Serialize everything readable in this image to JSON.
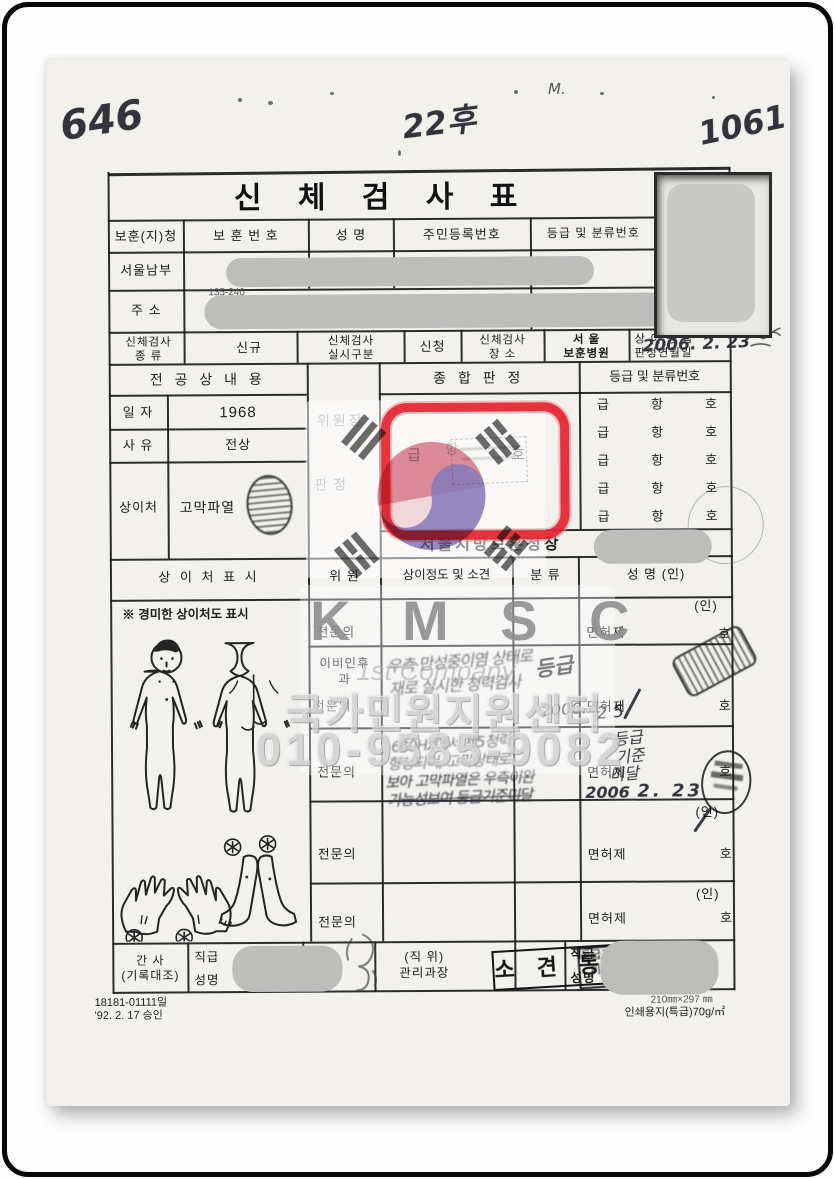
{
  "scan_margin_notes": {
    "left": "646",
    "center": "22후",
    "right": "1061",
    "speck": "M."
  },
  "form": {
    "title": "신  체  검  사  표",
    "header": {
      "office_col": "보훈(지)청",
      "vet_no_col": "보 훈 번 호",
      "name_col": "성    명",
      "resident_no_col": "주민등록번호",
      "grade_col": "등급 및 분류번호",
      "office_value": "서울남부"
    },
    "address": {
      "label": "주   소",
      "zip": "135-240"
    },
    "exam_row": {
      "kind_l1": "신체검사",
      "kind_l2": "종    류",
      "kind_value": "신규",
      "method_l1": "신체검사",
      "method_l2": "실시구분",
      "method_value": "신청",
      "place_l1": "신체검사",
      "place_l2": "장      소",
      "place_v1": "서    울",
      "place_v2": "보훈병원",
      "date_l1": "상 이 등 급",
      "date_l2": "판정연월일",
      "date_value": "2006. 2. 23"
    },
    "merit": {
      "header": "전  공  상  내  용",
      "date_label": "일  자",
      "date_value": "1968",
      "cause_label": "사  유",
      "cause_value": "전상",
      "wound_label": "상이처",
      "wound_value": "고막파열"
    },
    "judgement": {
      "chairman": "위원장",
      "decision": "판    정",
      "header": "종  합  판  정",
      "geup": "급",
      "hang": "항",
      "ho": "호",
      "grade_header": "등급  및  분류번호",
      "signer": "서울지방보훈청장"
    },
    "committee": {
      "h_wound": "상  이  처  표  시",
      "h_member": "위    원",
      "h_opinion": "상이정도 및 소견",
      "h_class": "분  류",
      "h_name": "성      명  (인)",
      "mild_note": "※  경미한 상이처도 표시",
      "specialist": "전문의",
      "ent_l1": "이비인후",
      "ent_l2": "과",
      "license": "면허제",
      "ho": "호",
      "in": "(인)"
    },
    "handwritten": {
      "r2_note1": "우측 만성중이염 상태로",
      "r2_note2": "재로 실시한 청력검사",
      "r2_class": "등급",
      "r2_date": "2006. 1.",
      "r2_day": "2 5",
      "r3_note1": "600Hz에서 제5청력",
      "r3_note2": "형성되어, 고막상태로",
      "r3_note3": "보아 고막파열은 우측이완",
      "r3_note4": "가능성보여 등급기준미달",
      "r3_class1": "등급",
      "r3_class2": "기준",
      "r3_class3": "미달",
      "r3_year": "2006",
      "r3_date": "2. 23"
    },
    "stamps": {
      "opinion": "소 견 동 일",
      "below1": "등급기준",
      "below2": "미 달"
    },
    "admin": {
      "clerk_l1": "간   사",
      "clerk_l2": "(기록대조)",
      "rank": "직급",
      "name": "성명",
      "pos_l1": "(직  위)",
      "pos_l2": "관리과장",
      "rank2": "직급",
      "name2": "성명"
    },
    "footer": {
      "form_no": "18181-01111일",
      "approved": "'92. 2. 17 승인",
      "size": "210㎜×297 ㎜",
      "paper": "인쇄용지(특급)70g/㎡"
    }
  },
  "watermark": {
    "kmsc": "K  M  S  C",
    "company": "1st Company",
    "center_name": "국가민원지원센터",
    "phone": "010-9585-9082"
  },
  "colors": {
    "highlight_red": "#e3232c",
    "flag_red": "#cf5b6b",
    "flag_blue": "#4a5ec5",
    "redaction": "#bdbdbc"
  }
}
